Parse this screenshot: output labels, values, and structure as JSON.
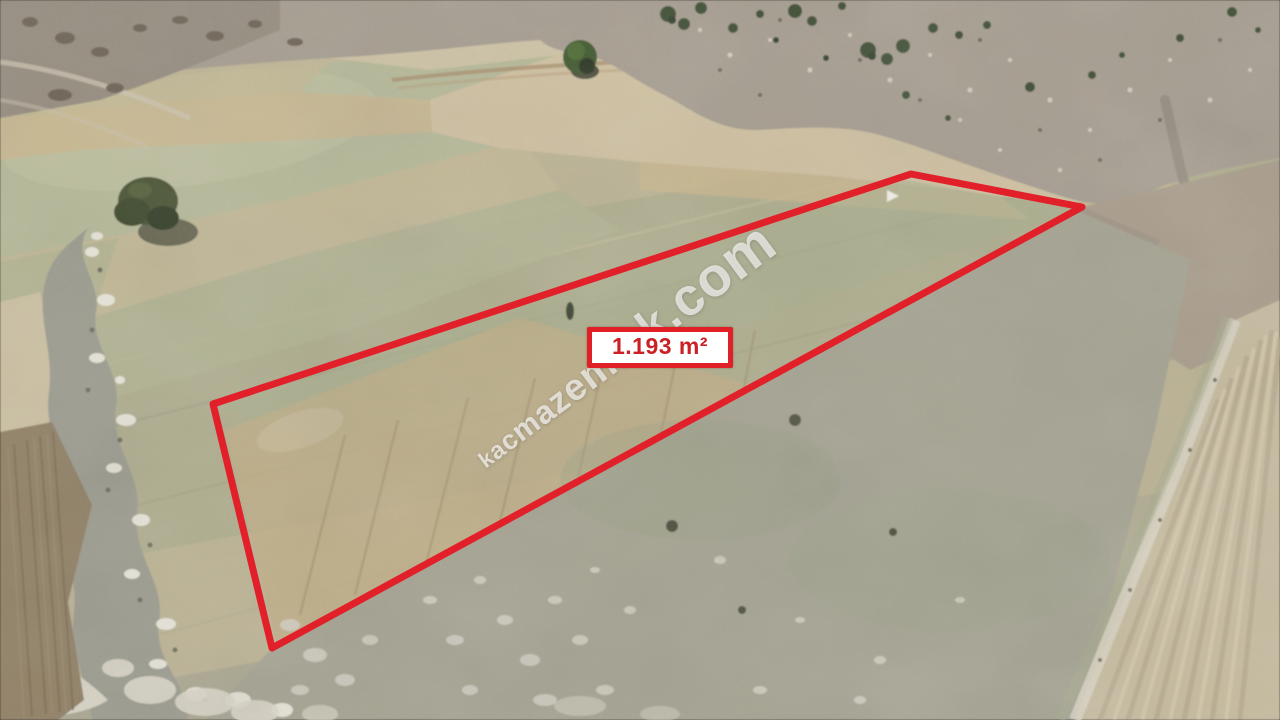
{
  "scene": {
    "kind": "aerial-drone-photo",
    "description": "Drone photo of dry rural farmland: tan and sage-green field strips, a rocky creek bed with white stones on the left, a plowed brown strip at the far left edge, gray pebbly scrubland with dark juniper bushes along the top, two lone dark-green trees, a stone-speckled gray pasture below, and a diagonally striped harvested field in the bottom-right corner."
  },
  "overlay": {
    "area_label": "1.193 m²",
    "watermark": "kacmazemlak.com",
    "parcel_outline_color": "#e2202a",
    "label_border_color": "#e01f27",
    "label_bg_color": "#ffffff",
    "label_text_color": "#cb2026",
    "watermark_color": "rgba(255,255,255,0.66)",
    "parcel_polygon_px": [
      [
        911,
        174
      ],
      [
        1082,
        207
      ],
      [
        272,
        648
      ],
      [
        213,
        404
      ]
    ]
  }
}
